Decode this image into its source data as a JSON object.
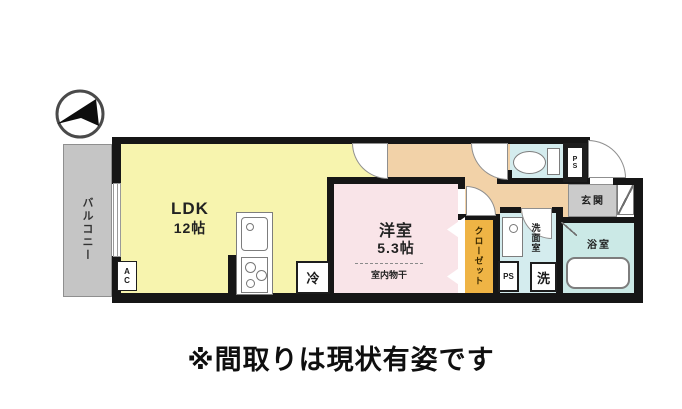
{
  "caption": "※間取りは現状有姿です",
  "compass": {
    "icon": "north-arrow"
  },
  "balcony": {
    "label": "バルコニー"
  },
  "ldk": {
    "name": "LDK",
    "size": "12帖",
    "ac": "AC",
    "fridge": "冷"
  },
  "western_room": {
    "name": "洋室",
    "size": "5.3帖",
    "drying": "室内物干"
  },
  "closet": {
    "label": "クローゼット"
  },
  "toilet": {
    "ps": "PS"
  },
  "washroom": {
    "label": "洗面室",
    "washer": "洗",
    "ps": "PS"
  },
  "bathroom": {
    "label": "浴室"
  },
  "entrance": {
    "label": "玄関"
  },
  "colors": {
    "wall": "#161616",
    "ldk_floor": "#f7f4ae",
    "western_floor": "#f9e4e8",
    "hallway_floor": "#f2d2a8",
    "wet_area_floor": "#d4ecee",
    "bathroom_floor": "#cbe9e6",
    "closet_floor": "#efb445",
    "balcony_floor": "#c5c5c5",
    "entrance_floor": "#cbcbcb"
  }
}
